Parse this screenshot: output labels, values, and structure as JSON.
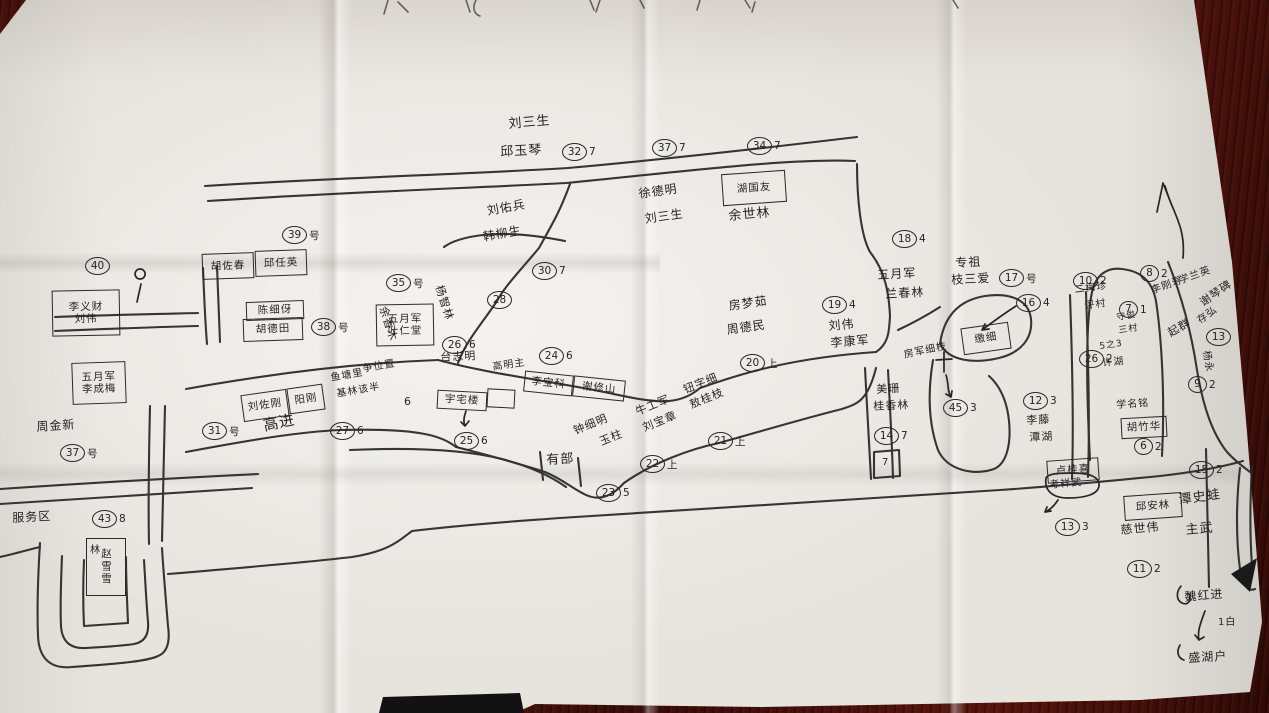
{
  "photo": {
    "kind": "hand-drawn village house-numbering sketch map on creased paper, photographed on a dark red-brown wooden table",
    "colors": {
      "table": "#4a130e",
      "paper": "#e7e4de",
      "ink": "#242424"
    }
  },
  "map": {
    "labels": [
      {
        "t": "刘三生",
        "x": 508,
        "y": 118,
        "s": 13,
        "r": -5
      },
      {
        "t": "邱玉琴",
        "x": 500,
        "y": 146,
        "s": 13,
        "r": -3
      },
      {
        "t": "刘佑兵",
        "x": 486,
        "y": 205,
        "s": 12,
        "r": -10
      },
      {
        "t": "韩柳生",
        "x": 482,
        "y": 231,
        "s": 12,
        "r": -10
      },
      {
        "t": "徐德明",
        "x": 638,
        "y": 188,
        "s": 12,
        "r": -8
      },
      {
        "t": "刘三生",
        "x": 644,
        "y": 213,
        "s": 12,
        "r": -8
      },
      {
        "t": "余世林",
        "x": 728,
        "y": 210,
        "s": 13,
        "r": -5
      },
      {
        "t": "周金新",
        "x": 36,
        "y": 421,
        "s": 12,
        "r": -4
      },
      {
        "t": "服务区",
        "x": 12,
        "y": 512,
        "s": 12,
        "r": -3
      },
      {
        "t": "高进",
        "x": 262,
        "y": 419,
        "s": 15,
        "r": -12
      },
      {
        "t": "鱼塘里",
        "x": 330,
        "y": 374,
        "s": 10,
        "r": -10
      },
      {
        "t": "争位置",
        "x": 362,
        "y": 365,
        "s": 10,
        "r": -10
      },
      {
        "t": "基林该半",
        "x": 336,
        "y": 390,
        "s": 10,
        "r": -10
      },
      {
        "t": "6",
        "x": 404,
        "y": 396,
        "s": 11,
        "r": 0
      },
      {
        "t": "台志明",
        "x": 440,
        "y": 352,
        "s": 11,
        "r": -3
      },
      {
        "t": "高明主",
        "x": 492,
        "y": 363,
        "s": 10,
        "r": -8
      },
      {
        "t": "有部",
        "x": 546,
        "y": 454,
        "s": 13,
        "r": -3
      },
      {
        "t": "钟细明",
        "x": 572,
        "y": 426,
        "s": 11,
        "r": -22
      },
      {
        "t": "玉柱",
        "x": 598,
        "y": 437,
        "s": 11,
        "r": -22
      },
      {
        "t": "牛工军",
        "x": 634,
        "y": 407,
        "s": 11,
        "r": -22
      },
      {
        "t": "刘宝章",
        "x": 641,
        "y": 423,
        "s": 11,
        "r": -22
      },
      {
        "t": "钮字细",
        "x": 682,
        "y": 385,
        "s": 11,
        "r": -22
      },
      {
        "t": "敖桂枝",
        "x": 688,
        "y": 400,
        "s": 11,
        "r": -22
      },
      {
        "t": "房梦茹",
        "x": 728,
        "y": 300,
        "s": 12,
        "r": -8
      },
      {
        "t": "周德民",
        "x": 726,
        "y": 324,
        "s": 12,
        "r": -8
      },
      {
        "t": "刘伟",
        "x": 828,
        "y": 320,
        "s": 12,
        "r": -5
      },
      {
        "t": "李康军",
        "x": 830,
        "y": 337,
        "s": 12,
        "r": -5
      },
      {
        "t": "五月军",
        "x": 877,
        "y": 269,
        "s": 12,
        "r": -3
      },
      {
        "t": "兰春林",
        "x": 885,
        "y": 288,
        "s": 12,
        "r": -3
      },
      {
        "t": "专祖",
        "x": 955,
        "y": 257,
        "s": 12,
        "r": -3
      },
      {
        "t": "枝三爱",
        "x": 951,
        "y": 274,
        "s": 12,
        "r": -3
      },
      {
        "t": "杨智林",
        "x": 444,
        "y": 284,
        "s": 11,
        "r": 72
      },
      {
        "t": "余香木",
        "x": 388,
        "y": 305,
        "s": 11,
        "r": 72
      },
      {
        "t": "房军细枝",
        "x": 903,
        "y": 351,
        "s": 10,
        "r": -12
      },
      {
        "t": "美珊",
        "x": 876,
        "y": 384,
        "s": 11,
        "r": -3
      },
      {
        "t": "桂香林",
        "x": 873,
        "y": 401,
        "s": 11,
        "r": -3
      },
      {
        "t": "李藤",
        "x": 1026,
        "y": 415,
        "s": 11,
        "r": -3
      },
      {
        "t": "潭湖",
        "x": 1029,
        "y": 432,
        "s": 11,
        "r": -3
      },
      {
        "t": "考祥武",
        "x": 1049,
        "y": 481,
        "s": 10,
        "r": -5
      },
      {
        "t": "慈世伟",
        "x": 1120,
        "y": 524,
        "s": 12,
        "r": -5
      },
      {
        "t": "潭史蛙",
        "x": 1178,
        "y": 494,
        "s": 13,
        "r": -8
      },
      {
        "t": "主武",
        "x": 1185,
        "y": 524,
        "s": 13,
        "r": -5
      },
      {
        "t": "二梅珍",
        "x": 1074,
        "y": 286,
        "s": 10,
        "r": -8
      },
      {
        "t": "评村",
        "x": 1084,
        "y": 302,
        "s": 10,
        "r": -8
      },
      {
        "t": "守俊",
        "x": 1116,
        "y": 314,
        "s": 9,
        "r": -8
      },
      {
        "t": "三村",
        "x": 1118,
        "y": 327,
        "s": 9,
        "r": -8
      },
      {
        "t": "5之3",
        "x": 1099,
        "y": 343,
        "s": 9,
        "r": -8
      },
      {
        "t": "许湖",
        "x": 1102,
        "y": 359,
        "s": 10,
        "r": -5
      },
      {
        "t": "学名铭",
        "x": 1116,
        "y": 401,
        "s": 10,
        "r": -4
      },
      {
        "t": "李刚寿",
        "x": 1150,
        "y": 287,
        "s": 10,
        "r": -20
      },
      {
        "t": "学兰英",
        "x": 1178,
        "y": 277,
        "s": 10,
        "r": -20
      },
      {
        "t": "谢琴碑",
        "x": 1198,
        "y": 299,
        "s": 11,
        "r": -35
      },
      {
        "t": "起群",
        "x": 1166,
        "y": 329,
        "s": 11,
        "r": -30
      },
      {
        "t": "存弘",
        "x": 1196,
        "y": 318,
        "s": 10,
        "r": -35
      },
      {
        "t": "杨永",
        "x": 1210,
        "y": 350,
        "s": 10,
        "r": 80
      },
      {
        "t": "魏红进",
        "x": 1184,
        "y": 591,
        "s": 12,
        "r": -5
      },
      {
        "t": "1白",
        "x": 1218,
        "y": 618,
        "s": 10,
        "r": 0
      },
      {
        "t": "盛湖户",
        "x": 1188,
        "y": 652,
        "s": 12,
        "r": -3
      },
      {
        "t": "林",
        "x": 90,
        "y": 546,
        "s": 10,
        "r": 0
      },
      {
        "t": "7",
        "x": 882,
        "y": 458,
        "s": 10,
        "r": 0
      }
    ],
    "markers": [
      {
        "n": "32",
        "sfx": "7",
        "x": 573,
        "y": 152
      },
      {
        "n": "37",
        "sfx": "7",
        "x": 663,
        "y": 148
      },
      {
        "n": "34",
        "sfx": "7",
        "x": 758,
        "y": 146
      },
      {
        "n": "39",
        "sfx": "号",
        "x": 293,
        "y": 235
      },
      {
        "n": "40",
        "sfx": "",
        "x": 96,
        "y": 266
      },
      {
        "n": "38",
        "sfx": "号",
        "x": 322,
        "y": 327
      },
      {
        "n": "35",
        "sfx": "号",
        "x": 397,
        "y": 283
      },
      {
        "n": "30",
        "sfx": "7",
        "x": 543,
        "y": 271
      },
      {
        "n": "28",
        "sfx": "",
        "x": 498,
        "y": 300
      },
      {
        "n": "24",
        "sfx": "6",
        "x": 550,
        "y": 356
      },
      {
        "n": "26",
        "sfx": "6",
        "x": 453,
        "y": 345
      },
      {
        "n": "27",
        "sfx": "6",
        "x": 341,
        "y": 431
      },
      {
        "n": "31",
        "sfx": "号",
        "x": 213,
        "y": 431
      },
      {
        "n": "37",
        "sfx": "号",
        "x": 71,
        "y": 453
      },
      {
        "n": "43",
        "sfx": "8",
        "x": 103,
        "y": 519
      },
      {
        "n": "25",
        "sfx": "6",
        "x": 465,
        "y": 441
      },
      {
        "n": "23",
        "sfx": "5",
        "x": 607,
        "y": 493
      },
      {
        "n": "22",
        "sfx": "上",
        "x": 651,
        "y": 464
      },
      {
        "n": "21",
        "sfx": "上",
        "x": 719,
        "y": 441
      },
      {
        "n": "20",
        "sfx": "上",
        "x": 751,
        "y": 363
      },
      {
        "n": "19",
        "sfx": "4",
        "x": 833,
        "y": 305
      },
      {
        "n": "18",
        "sfx": "4",
        "x": 903,
        "y": 239
      },
      {
        "n": "17",
        "sfx": "号",
        "x": 1010,
        "y": 278
      },
      {
        "n": "16",
        "sfx": "4",
        "x": 1027,
        "y": 303
      },
      {
        "n": "45",
        "sfx": "3",
        "x": 954,
        "y": 408
      },
      {
        "n": "14",
        "sfx": "7",
        "x": 885,
        "y": 436
      },
      {
        "n": "12",
        "sfx": "3",
        "x": 1034,
        "y": 401
      },
      {
        "n": "13",
        "sfx": "3",
        "x": 1066,
        "y": 527
      },
      {
        "n": "15",
        "sfx": "2",
        "x": 1200,
        "y": 470
      },
      {
        "n": "11",
        "sfx": "2",
        "x": 1138,
        "y": 569
      },
      {
        "n": "6",
        "sfx": "2",
        "x": 1142,
        "y": 447
      },
      {
        "n": "10",
        "sfx": "2",
        "x": 1084,
        "y": 281
      },
      {
        "n": "7",
        "sfx": "1",
        "x": 1127,
        "y": 310
      },
      {
        "n": "26",
        "sfx": "2",
        "x": 1090,
        "y": 359
      },
      {
        "n": "8",
        "sfx": "2",
        "x": 1148,
        "y": 274
      },
      {
        "n": "13",
        "sfx": "",
        "x": 1217,
        "y": 337
      },
      {
        "n": "9",
        "sfx": "2",
        "x": 1196,
        "y": 385
      }
    ],
    "boxes": [
      {
        "lines": [
          "胡佐春"
        ],
        "x": 202,
        "y": 253,
        "w": 50,
        "h": 24,
        "r": -2
      },
      {
        "lines": [
          "邱任英"
        ],
        "x": 255,
        "y": 250,
        "w": 50,
        "h": 24,
        "r": -2
      },
      {
        "lines": [
          "李义财",
          "刘伟"
        ],
        "x": 52,
        "y": 290,
        "w": 66,
        "h": 44,
        "r": -1
      },
      {
        "lines": [
          "陈细伢"
        ],
        "x": 246,
        "y": 301,
        "w": 56,
        "h": 17,
        "r": -2
      },
      {
        "lines": [
          "胡德田"
        ],
        "x": 243,
        "y": 318,
        "w": 58,
        "h": 21,
        "r": -2
      },
      {
        "lines": [
          "五月军",
          "叶仁堂"
        ],
        "x": 376,
        "y": 304,
        "w": 56,
        "h": 40,
        "r": -1
      },
      {
        "lines": [
          "五月军",
          "李成梅"
        ],
        "x": 72,
        "y": 362,
        "w": 52,
        "h": 40,
        "r": -2
      },
      {
        "lines": [
          "刘佐刚"
        ],
        "x": 242,
        "y": 392,
        "w": 44,
        "h": 25,
        "r": -8
      },
      {
        "lines": [
          "阳刚"
        ],
        "x": 288,
        "y": 386,
        "w": 34,
        "h": 24,
        "r": -8
      },
      {
        "lines": [
          "李宝科"
        ],
        "x": 524,
        "y": 373,
        "w": 47,
        "h": 19,
        "r": 6
      },
      {
        "lines": [
          "谢修山"
        ],
        "x": 573,
        "y": 378,
        "w": 50,
        "h": 19,
        "r": 6
      },
      {
        "lines": [
          "湖国友"
        ],
        "x": 722,
        "y": 172,
        "w": 62,
        "h": 30,
        "r": -4
      },
      {
        "lines": [
          "宇宅楼"
        ],
        "x": 437,
        "y": 391,
        "w": 48,
        "h": 17,
        "r": 3
      },
      {
        "lines": [],
        "x": 487,
        "y": 389,
        "w": 26,
        "h": 17,
        "r": 3
      },
      {
        "lines": [
          "邱安林"
        ],
        "x": 1124,
        "y": 494,
        "w": 56,
        "h": 23,
        "r": -4
      },
      {
        "lines": [
          "卢桂喜"
        ],
        "x": 1047,
        "y": 459,
        "w": 50,
        "h": 21,
        "r": -4
      },
      {
        "lines": [
          "胡竹华"
        ],
        "x": 1121,
        "y": 417,
        "w": 44,
        "h": 19,
        "r": -3
      },
      {
        "lines": [
          "缴细"
        ],
        "x": 962,
        "y": 325,
        "w": 46,
        "h": 25,
        "r": -8
      },
      {
        "lines": [
          "赵雪雪"
        ],
        "x": 86,
        "y": 538,
        "w": 38,
        "h": 56,
        "r": 0,
        "v": true
      }
    ],
    "icons": [
      "north-arrow-icon",
      "location-pin-icon"
    ]
  }
}
